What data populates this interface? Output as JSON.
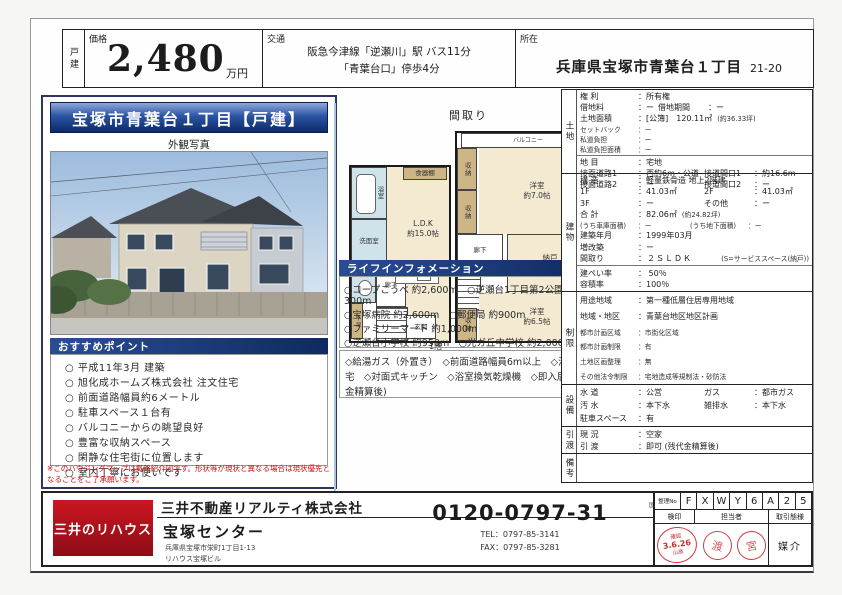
{
  "header": {
    "category": "戸建",
    "price_label": "価格",
    "price_value": "2,480",
    "price_unit": "万円",
    "access_label": "交通",
    "access_line1": "阪急今津線「逆瀬川」駅 バス11分",
    "access_line2": "「青葉台口」停歩4分",
    "location_label": "所在",
    "location_value": "兵庫県宝塚市青葉台１丁目",
    "location_number": "21-20"
  },
  "left_panel": {
    "title": "宝塚市青葉台１丁目【戸建】",
    "photo_caption": "外観写真",
    "recommend_header": "おすすめポイント",
    "recommend_items": [
      "○ 平成11年3月 建築",
      "○ 旭化成ホームズ株式会社 注文住宅",
      "○ 前面道路幅員約6メートル",
      "○ 駐車スペース１台有",
      "○ バルコニーからの眺望良好",
      "○ 豊富な収納スペース",
      "○ 閑静な住宅街に位置します",
      "○ 室内丁寧にお使いです"
    ],
    "note": "※このハウジングマップは概略紹介図です。形状等が現状と異なる場合は現状優先となることをご了承願います。"
  },
  "floorplan": {
    "title": "間取り",
    "f1": {
      "bath": "浴室",
      "cupboard": "食器棚",
      "wash": "洗面室",
      "toilet": "トイレ",
      "hall": "廊下",
      "ldk": "L.D.K",
      "ldk_size": "約15.0帖",
      "shoe": "下足",
      "entrance": "玄関",
      "label": "1階"
    },
    "f2": {
      "balcony": "バルコニー",
      "closet1": "収納",
      "closet2": "収納",
      "closet3": "収納",
      "hall": "廊下",
      "room1": "洋室",
      "room1_size": "約7.0帖",
      "storage": "納戸",
      "storage_size": "約4.5帖",
      "room2": "洋室",
      "room2_size": "約6.5帖",
      "label": "2階"
    }
  },
  "life": {
    "header": "ライフインフォメーション",
    "lines": [
      "○コープこうべ 約2,600m　○逆瀬台1丁目第2公園 約300m",
      "○宝塚病院 約2,600m　○郵便局 約900m",
      "○ファミリーマート 約1,000m",
      "○逆瀬台小学校 約950m　○光ガ丘中学校 約2,000m"
    ],
    "features": "◇給湯ガス（外置き）　◇前面道路幅員6m以上　◇注文住宅　◇対面式キッチン　◇浴室換気乾燥機　◇即入居可(残金精算後)"
  },
  "detail": {
    "land": {
      "label": "土地",
      "rows": [
        {
          "l": "権 利",
          "v": "：所有権"
        },
        {
          "l": "借地料",
          "v": "：ー",
          "l2": "借地期間",
          "v2": "：ー"
        },
        {
          "l": "土地面積",
          "v": "：[公簿]　120.11㎡",
          "x": "(約36.33坪)"
        },
        {
          "l": "セットバック",
          "v": "：ー"
        },
        {
          "l": "私道負担",
          "v": "：ー"
        },
        {
          "l": "私道負担面積",
          "v": "：ー"
        },
        {
          "l": "地 目",
          "v": "：宅地"
        },
        {
          "l": "接面道路1",
          "v": "：西約6m・公道",
          "l2": "接道間口1",
          "v2": "：約16.6m"
        },
        {
          "l": "接面道路2",
          "v": "：ー",
          "l2": "接道間口2",
          "v2": "：ー"
        }
      ]
    },
    "building": {
      "label": "建物",
      "rows": [
        {
          "l": "構 造",
          "v": "：軽量鉄骨造 地上2階建"
        },
        {
          "l": "1F",
          "v": "：41.03㎡",
          "l2": "2F",
          "v2": "：41.03㎡"
        },
        {
          "l": "3F",
          "v": "：ー",
          "l2": "その他",
          "v2": "：ー"
        },
        {
          "l": "合 計",
          "v": "：82.06㎡",
          "x": "(約24.82坪)"
        },
        {
          "l": "(うち車庫面積)",
          "v": "：ー",
          "l2": "(うち地下面積)",
          "v2": "：ー"
        },
        {
          "l": "建築年月",
          "v": "：1999年03月"
        },
        {
          "l": "増改築",
          "v": "：ー"
        },
        {
          "l": "間取り",
          "v": "：２ＳＬＤＫ",
          "x": "(S=サービススペース(納戸))"
        },
        {
          "l": "建ぺい率",
          "v": "： 50％"
        },
        {
          "l": "容積率",
          "v": "：100％"
        }
      ]
    },
    "restrict": {
      "label": "制限",
      "rows": [
        {
          "l": "用途地域",
          "v": "：第一種低層住居専用地域"
        },
        {
          "l": "地域・地区",
          "v": "：青葉台地区地区計画"
        },
        {
          "l": "都市計画区域",
          "v": "：市街化区域"
        },
        {
          "l": "都市計画制限",
          "v": "：有"
        },
        {
          "l": "土地区画整理",
          "v": "：無"
        },
        {
          "l": "その他法令制限",
          "v": "：宅地造成等規制法・砂防法"
        }
      ]
    },
    "facility": {
      "label": "設備",
      "rows": [
        {
          "l": "水 道",
          "v": "：公営",
          "l2": "ガス",
          "v2": "：都市ガス"
        },
        {
          "l": "汚 水",
          "v": "：本下水",
          "l2": "雑排水",
          "v2": "：本下水"
        },
        {
          "l": "駐車スペース",
          "v": "：有"
        }
      ]
    },
    "delivery": {
      "label": "引渡",
      "rows": [
        {
          "l": "現 況",
          "v": "：空家"
        },
        {
          "l": "引 渡",
          "v": "：即可 (残代金精算後)"
        }
      ]
    },
    "notes": {
      "label": "備考"
    }
  },
  "footer": {
    "logo": "三井のリハウス",
    "company": "三井不動産リアルティ株式会社",
    "office": "宝塚センター",
    "address1": "兵庫県宝塚市栄町1丁目1-13",
    "address2": "リハウス宝塚ビル",
    "phone": "0120-0797-31",
    "tel": "TEL：0797-85-3141",
    "fax": "FAX：0797-85-3281",
    "legal": [
      "国土交通大臣（14）第777号",
      "（社）不動産協会会員",
      "（一社）不動産流通経営協会会員",
      "（公社）首都圏不動産公正取引協議会加盟"
    ],
    "serial_label": "整理No",
    "serial": [
      "F",
      "X",
      "W",
      "Y",
      "6",
      "A",
      "2",
      "5"
    ],
    "col_checkseal": "検印",
    "col_agent": "担当者",
    "col_type": "取引態様",
    "type_value": "媒介",
    "stamp_confirm": "確認",
    "stamp_date": "3.6.26",
    "stamp_name": "山高",
    "seal1": "渡",
    "seal2": "宮"
  }
}
